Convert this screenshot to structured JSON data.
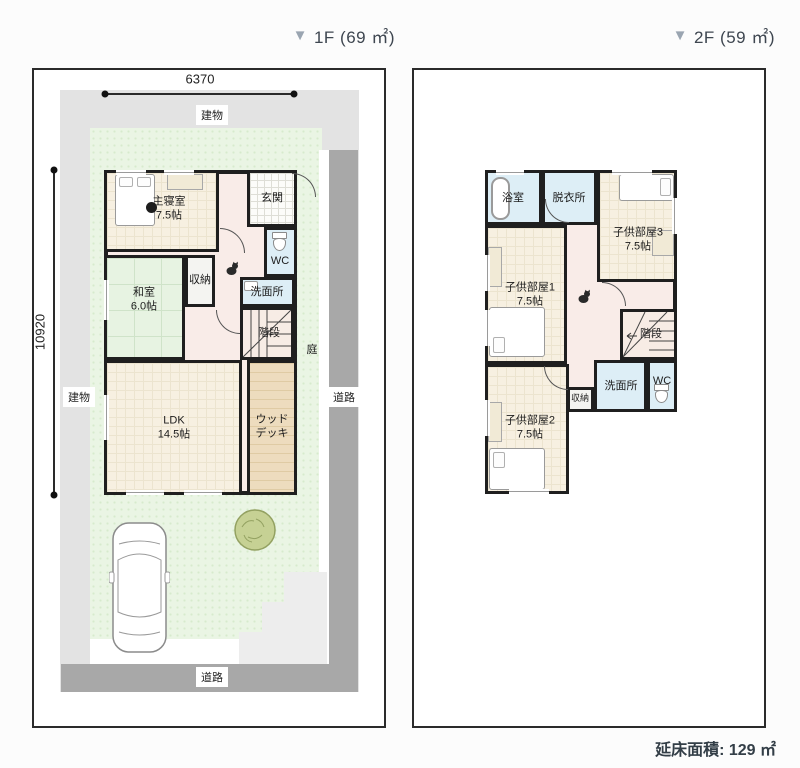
{
  "icons": {
    "floor_marker": "▼"
  },
  "header": {
    "floor1_label": "1F (69 ㎡)",
    "floor2_label": "2F (59 ㎡)"
  },
  "footer": {
    "total_area": "延床面積: 129 ㎡"
  },
  "floor1": {
    "dim_width": "6370",
    "dim_height": "10920",
    "site_labels": {
      "building_top": "建物",
      "building_left": "建物",
      "road_right": "道路",
      "road_bottom": "道路",
      "garden": "庭"
    },
    "rooms": {
      "master_bedroom": {
        "name": "主寝室",
        "size": "7.5帖"
      },
      "entrance": {
        "name": "玄関"
      },
      "toilet": {
        "name": "WC"
      },
      "storage": {
        "name": "収納"
      },
      "washroom": {
        "name": "洗面所"
      },
      "japanese_room": {
        "name": "和室",
        "size": "6.0帖"
      },
      "stairs": {
        "name": "階段"
      },
      "ldk": {
        "name": "LDK",
        "size": "14.5帖"
      },
      "wood_deck": {
        "name": "ウッドデッキ"
      }
    }
  },
  "floor2": {
    "rooms": {
      "bathroom": {
        "name": "浴室"
      },
      "dressing_room": {
        "name": "脱衣所"
      },
      "kids_room3": {
        "name": "子供部屋3",
        "size": "7.5帖"
      },
      "kids_room1": {
        "name": "子供部屋1",
        "size": "7.5帖"
      },
      "stairs": {
        "name": "階段"
      },
      "washroom": {
        "name": "洗面所"
      },
      "toilet": {
        "name": "WC"
      },
      "storage": {
        "name": "収納"
      },
      "kids_room2": {
        "name": "子供部屋2",
        "size": "7.5帖"
      }
    }
  },
  "colors": {
    "triangle": "#9aa5b1",
    "wall": "#1f1f1f",
    "lawn": "#eaf5e4",
    "site": "#e3e3e3",
    "road": "#a8a8a8",
    "flooring": "#f7f0e1",
    "tatami": "#e7f3e2",
    "water_rooms": "#ddeef6",
    "hallway": "#f9ece8",
    "wood_deck": "#eddcbe"
  }
}
